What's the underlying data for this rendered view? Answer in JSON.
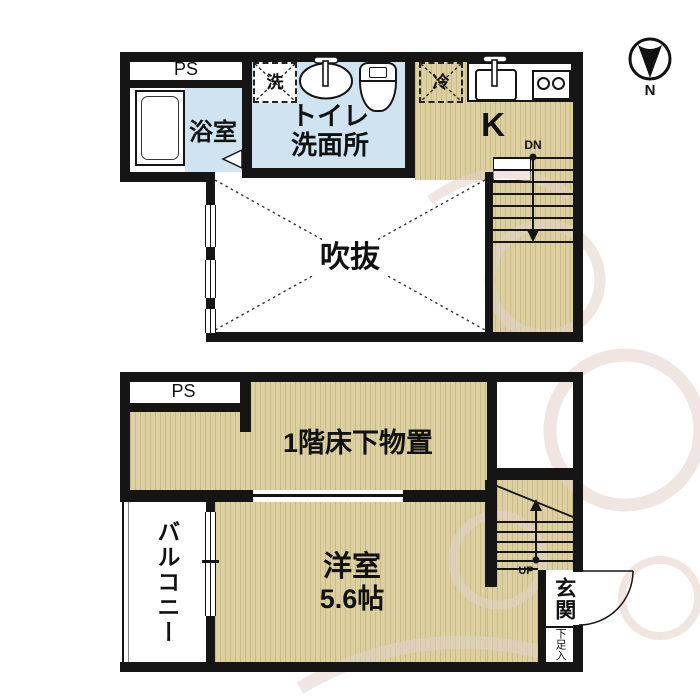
{
  "compass": {
    "label": "N"
  },
  "upper_floor": {
    "ps_label": "PS",
    "bath_label": "浴室",
    "washer_label": "洗",
    "toilet_line1": "トイレ",
    "toilet_line2": "洗面所",
    "fridge_label": "冷",
    "kitchen_label": "K",
    "stairs_label": "DN",
    "void_label": "吹抜"
  },
  "lower_floor": {
    "ps_label": "PS",
    "storage_label": "1階床下物置",
    "balcony_label": "バルコニー",
    "room_label": "洋室",
    "room_size": "5.6帖",
    "stairs_label": "UP",
    "entrance_label": "玄関",
    "shoe_label": "下足入"
  },
  "colors": {
    "wall": "#151515",
    "floor_tan": "#dccfa0",
    "water_blue": "#cfe4f0",
    "background": "#ffffff",
    "watermark": "#e2d2cc"
  }
}
